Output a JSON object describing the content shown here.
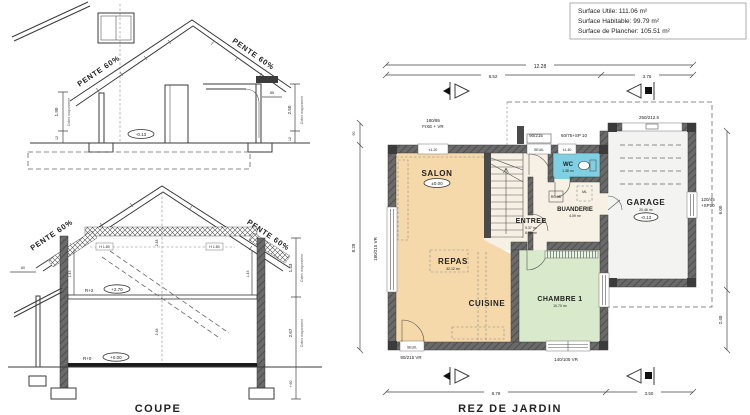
{
  "surface_box": {
    "utile": "Surface Utile: 111.06 m²",
    "habitable": "Surface Habitable: 99.79 m²",
    "plancher": "Surface de Plancher: 105.51 m²"
  },
  "titles": {
    "coupe": "COUPE",
    "plan": "REZ DE JARDIN"
  },
  "coupe_top": {
    "pente_left": "PENTE 60%",
    "pente_right": "PENTE 60%",
    "level": "-0.13",
    "dim_h": "1.90",
    "dim_h_base": "12",
    "note_left": "Cotes maçonnerie",
    "dim_h2": "2.50",
    "dim_h2_base": "12",
    "note_right": "Cotes maçonnerie",
    "dim_door": "85"
  },
  "coupe_bot": {
    "pente_left": "PENTE 60%",
    "pente_right": "PENTE 60%",
    "r2": "R+2",
    "r2_level": "+2.70",
    "r0": "R+0",
    "r0_level": "+0.00",
    "dim_up": "1.43",
    "dim_low": "2.67",
    "note_up": "Cotes maçonnerie",
    "note_low": "Cotes maçonnerie",
    "dim_base": "+ 60",
    "dim_eave": "60",
    "dim_c1": "2.48",
    "dim_c2": "2.48",
    "dim_k1": "1.43",
    "dim_k2": "1.43",
    "headroom1": "H 1.80",
    "headroom2": "H 1.80"
  },
  "plan": {
    "dim_top_total": "12.28",
    "dim_top_left": "8.52",
    "dim_top_right": "3.76",
    "dim_bot_left": "8.78",
    "dim_bot_right": "3.50",
    "dim_left_up": ".90",
    "dim_left": "8.28",
    "dim_right_up": "6.00",
    "dim_right_low": "2.40",
    "win_tl_1": "180/95",
    "win_tl_2": "FIXE + VR",
    "door_entry": "90/215",
    "win_wc": "60/75+SP 10",
    "garage_door": "250/212.5",
    "win_left": "180/215 VR",
    "win_bl": "90/215 VR",
    "win_br": "140/105 VR",
    "win_gar_1": "120/45",
    "win_gar_2": "+SP10",
    "sill_tl": "±1.20",
    "sill_entry": "SEUIL",
    "sill_wc": "±1.40",
    "sill_bl": "SEUIL",
    "salon": "SALON",
    "salon_level": "±0.00",
    "repas": "REPAS",
    "repas_area": "32.12 m²",
    "cuisine": "CUISINE",
    "entree": "ENTREE",
    "entree_a1": "9.37 m²",
    "entree_a2": "6.96 m²",
    "wc": "WC",
    "wc_area": "1.38 m²",
    "buanderie": "BUANDERIE",
    "buanderie_area": "4.09 m²",
    "ml": "ML",
    "equip": "RC 3D",
    "chambre": "CHAMBRE 1",
    "chambre_area": "10.70 m²",
    "garage": "GARAGE",
    "garage_area": "20.46 m²",
    "garage_level": "-0.13"
  },
  "colors": {
    "living": "#f6d9ab",
    "bedroom": "#d9e9cb",
    "wc": "#7fd0e2",
    "hall": "#f6f1e4",
    "garage": "#f3f3f1"
  }
}
